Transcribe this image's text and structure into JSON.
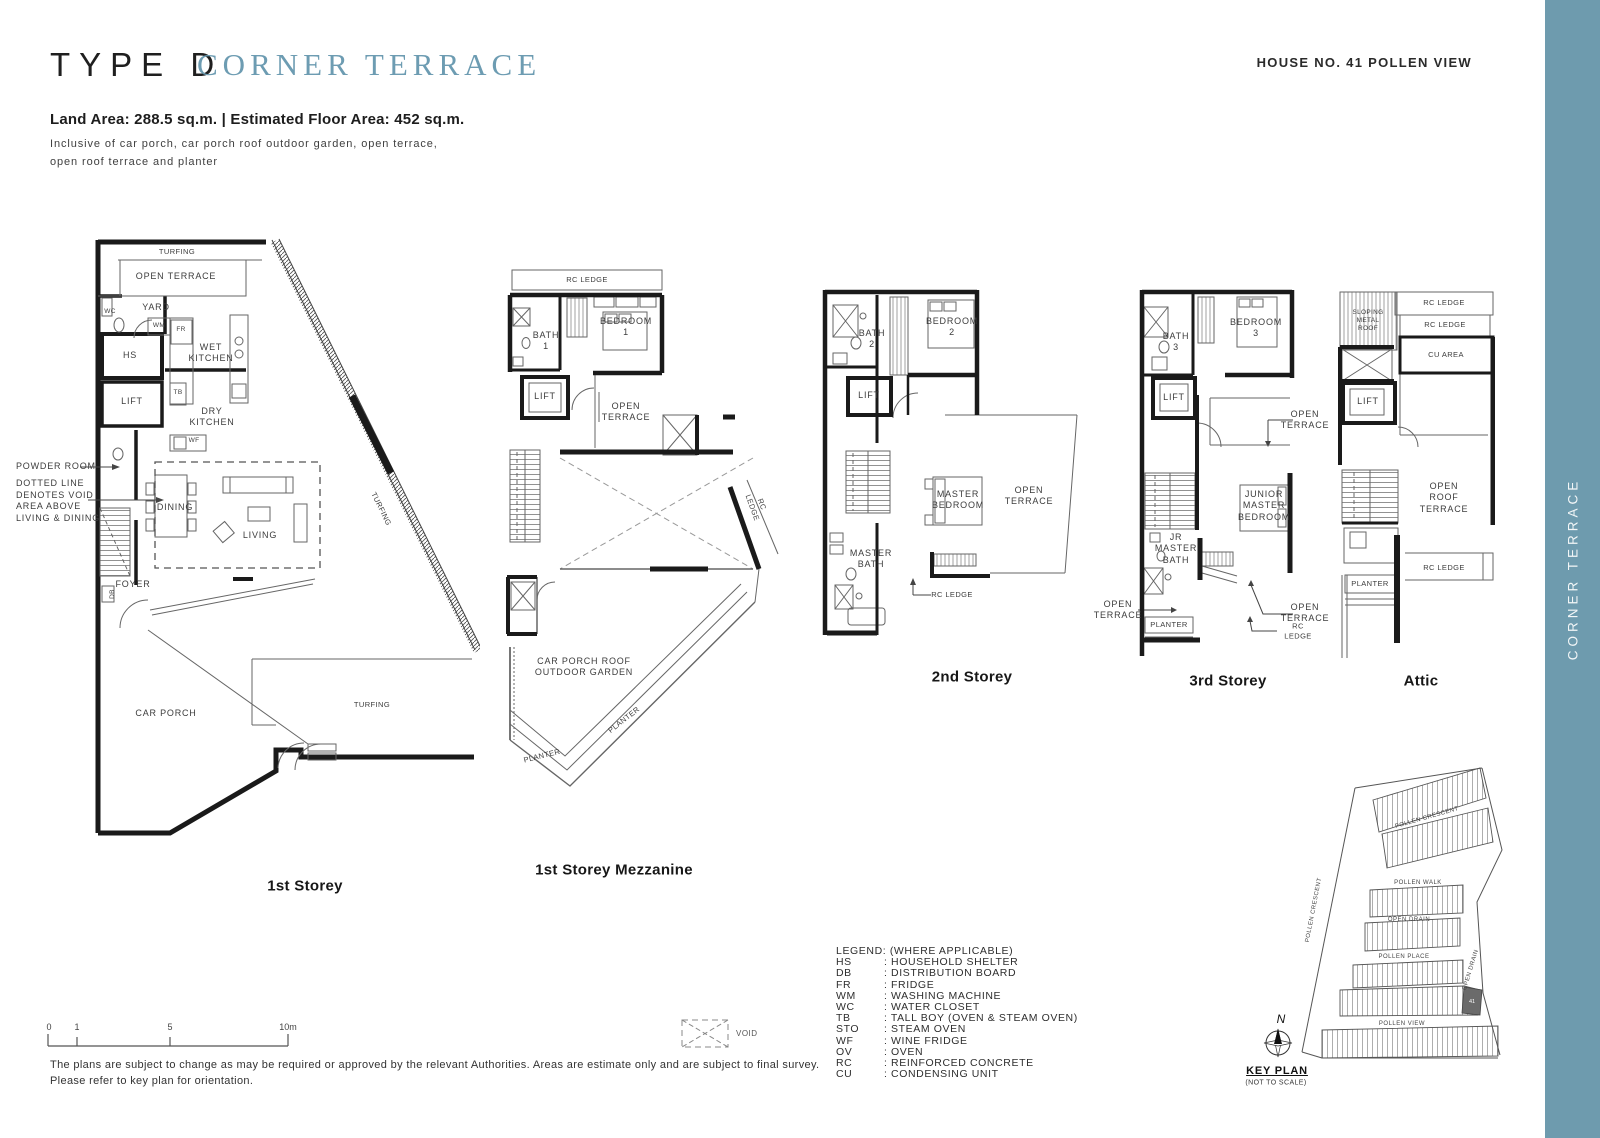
{
  "header": {
    "type_label": "TYPE D",
    "type_name": "CORNER TERRACE",
    "house_no": "HOUSE NO. 41 POLLEN VIEW",
    "area_line": "Land Area: 288.5 sq.m.  |  Estimated Floor Area: 452 sq.m.",
    "inclusive_note": "Inclusive of car porch, car porch roof outdoor garden, open terrace,\nopen roof terrace and planter"
  },
  "sidebar": {
    "label": "CORNER TERRACE"
  },
  "colors": {
    "accent_teal": "#6e9bae",
    "title_teal": "#6d9cb2",
    "wall_black": "#1a1a1a"
  },
  "plans": {
    "s1": {
      "caption": "1st Storey",
      "labels": {
        "turfing_top": "TURFING",
        "open_terrace": "OPEN TERRACE",
        "wc": "WC",
        "yard": "YARD",
        "wm": "WM",
        "fr": "FR",
        "hs": "HS",
        "lift": "LIFT",
        "tb": "TB",
        "wet_kitchen": "WET\nKITCHEN",
        "dry_kitchen": "DRY\nKITCHEN",
        "wf": "WF",
        "powder_room": "POWDER ROOM",
        "void_note": "DOTTED LINE\nDENOTES VOID\nAREA ABOVE\nLIVING & DINING",
        "dining": "DINING",
        "living": "LIVING",
        "foyer": "FOYER",
        "db": "DB",
        "car_porch": "CAR PORCH",
        "turfing_bottom": "TURFING",
        "turfing_diag": "TURFING"
      }
    },
    "s2": {
      "caption": "1st Storey Mezzanine",
      "labels": {
        "rc_ledge_top": "RC LEDGE",
        "bath1": "BATH\n1",
        "bedroom1": "BEDROOM\n1",
        "lift": "LIFT",
        "open_terrace": "OPEN\nTERRACE",
        "rc_ledge_right": "RC LEDGE",
        "garden": "CAR PORCH ROOF\nOUTDOOR GARDEN",
        "planter_a": "PLANTER",
        "planter_b": "PLANTER"
      }
    },
    "s3": {
      "caption": "2nd Storey",
      "labels": {
        "bath2": "BATH\n2",
        "bedroom2": "BEDROOM\n2",
        "lift": "LIFT",
        "master_bedroom": "MASTER\nBEDROOM",
        "open_terrace": "OPEN\nTERRACE",
        "master_bath": "MASTER\nBATH",
        "rc_ledge": "RC LEDGE"
      }
    },
    "s4": {
      "caption": "3rd Storey",
      "labels": {
        "bath3": "BATH\n3",
        "bedroom3": "BEDROOM\n3",
        "lift": "LIFT",
        "open_terrace_top": "OPEN\nTERRACE",
        "junior_master": "JUNIOR\nMASTER\nBEDROOM",
        "jr_master_bath": "JR\nMASTER\nBATH",
        "open_terrace_left": "OPEN\nTERRACE",
        "planter": "PLANTER",
        "open_terrace_right": "OPEN\nTERRACE",
        "rc_ledge": "RC LEDGE"
      }
    },
    "s5": {
      "caption": "Attic",
      "labels": {
        "sloping_roof": "SLOPING\nMETAL\nROOF",
        "rc_ledge_1": "RC LEDGE",
        "rc_ledge_2": "RC LEDGE",
        "cu_area": "CU AREA",
        "lift": "LIFT",
        "open_roof_terrace": "OPEN\nROOF\nTERRACE",
        "rc_ledge_3": "RC LEDGE",
        "planter": "PLANTER"
      }
    }
  },
  "legend": {
    "title": "LEGEND: (WHERE APPLICABLE)",
    "items": [
      {
        "abbr": "HS",
        "desc": ": HOUSEHOLD SHELTER"
      },
      {
        "abbr": "DB",
        "desc": ": DISTRIBUTION BOARD"
      },
      {
        "abbr": "FR",
        "desc": ": FRIDGE"
      },
      {
        "abbr": "WM",
        "desc": ": WASHING MACHINE"
      },
      {
        "abbr": "WC",
        "desc": ": WATER CLOSET"
      },
      {
        "abbr": "TB",
        "desc": ": TALL BOY (OVEN & STEAM OVEN)"
      },
      {
        "abbr": "STO",
        "desc": ": STEAM OVEN"
      },
      {
        "abbr": "WF",
        "desc": ": WINE FRIDGE"
      },
      {
        "abbr": "OV",
        "desc": ": OVEN"
      },
      {
        "abbr": "RC",
        "desc": ": REINFORCED CONCRETE"
      },
      {
        "abbr": "CU",
        "desc": ": CONDENSING UNIT"
      }
    ]
  },
  "void_symbol": {
    "label": "VOID"
  },
  "scale_bar": {
    "t0": "0",
    "t1": "1",
    "t5": "5",
    "t10": "10m"
  },
  "disclaimer": "The plans are subject to change as may be required or approved by the relevant Authorities. Areas are estimate only and are subject to final survey.\nPlease refer to key plan for orientation.",
  "key_plan": {
    "title": "KEY PLAN",
    "subtitle": "(NOT TO SCALE)",
    "north": "N",
    "unit": "41",
    "streets": {
      "pollen_crescent_top": "POLLEN CRESCENT",
      "pollen_walk": "POLLEN WALK",
      "open_drain": "OPEN DRAIN",
      "pollen_place": "POLLEN PLACE",
      "pollen_view": "POLLEN VIEW",
      "pollen_crescent_left": "POLLEN CRESCENT",
      "open_drain_right": "OPEN DRAIN"
    }
  }
}
